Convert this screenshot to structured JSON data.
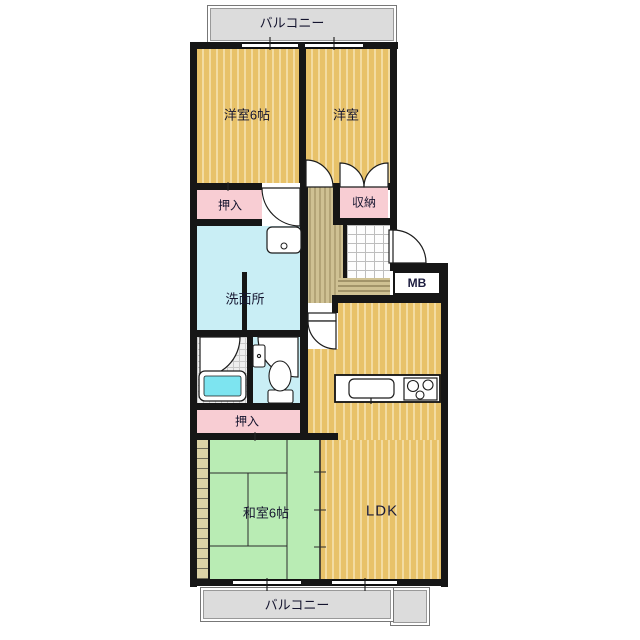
{
  "floorplan": {
    "title": "apartment-floor-plan",
    "balcony_top": "バルコニー",
    "balcony_bottom": "バルコニー",
    "rooms": {
      "western1": "洋室6帖",
      "western2": "洋室",
      "closet_top": "押入",
      "storage": "収納",
      "washroom": "洗面所",
      "meter_box": "MB",
      "closet_bottom": "押入",
      "japanese": "和室6帖",
      "ldk": "LDK"
    },
    "colors": {
      "wall": "#161616",
      "wood": "#e8c269",
      "wood-light": "#f3dca2",
      "hall": "#cfc193",
      "tatami": "#b9ecb4",
      "pink": "#f8cdd3",
      "aqua": "#c9eef5",
      "balcony": "#dcdcdc",
      "tub": "#7de4f0"
    }
  }
}
